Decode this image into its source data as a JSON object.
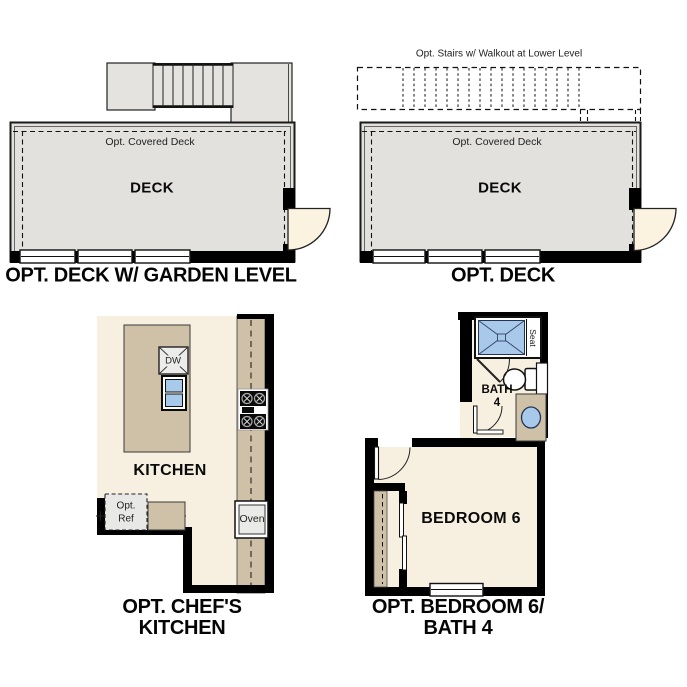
{
  "panels": {
    "deck_garden": {
      "caption": "OPT. DECK W/ GARDEN LEVEL",
      "covered_label": "Opt. Covered Deck",
      "room_label": "DECK"
    },
    "deck": {
      "caption": "OPT. DECK",
      "stairs_label": "Opt. Stairs w/ Walkout at Lower Level",
      "covered_label": "Opt. Covered Deck",
      "room_label": "DECK"
    },
    "kitchen": {
      "caption_line1": "OPT. CHEF'S",
      "caption_line2": "KITCHEN",
      "room_label": "KITCHEN",
      "dishwasher_label": "DW",
      "ref_label_line1": "Opt.",
      "ref_label_line2": "Ref",
      "oven_label": "Oven"
    },
    "bedroom": {
      "caption_line1": "OPT. BEDROOM 6/",
      "caption_line2": "BATH 4",
      "room_label": "BEDROOM 6",
      "bath_label_line1": "BATH",
      "bath_label_line2": "4",
      "seat_label": "Seat"
    }
  },
  "colors": {
    "deck_gray": "#e2e1de",
    "floor_cream": "#f7f0e0",
    "cabinet_tan": "#cfc1a8",
    "fixture_blue": "#a8c9e9",
    "door_cream": "#fbf2e0",
    "wall_black": "#000000"
  }
}
